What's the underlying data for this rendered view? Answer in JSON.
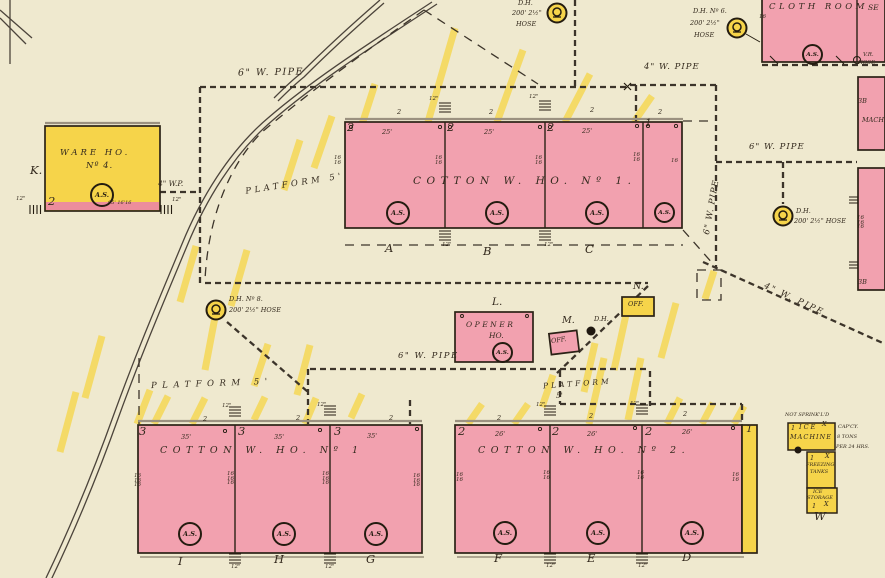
{
  "colors": {
    "background": "#efe9cf",
    "brick_pink": "#f2a1af",
    "brick_shade": "#ec8d9c",
    "frame_yellow": "#f6d44a",
    "stripe_yellow": "#f4d85e",
    "ink": "#33291d",
    "line": "#4c443b"
  },
  "tokens": {
    "as": "A.S.",
    "fire12": "12\"",
    "w16": "16",
    "w16x2": "16 16",
    "w16x3": "16 16 16",
    "story1": "1",
    "story2": "2",
    "story3": "3",
    "d25": "25'",
    "d26": "26'",
    "d35": "35'",
    "x_mark": "X"
  },
  "pipes": {
    "wp6": "6\" W. PIPE",
    "wp4": "4\" W. PIPE",
    "wp4_short": "4\" W.P."
  },
  "platforms": {
    "upper": "PLATFORM 5'",
    "lower_left": "PLATFORM 5'",
    "mid_right_1": "PLATFORM",
    "mid_right_2": "5'"
  },
  "hydrants": {
    "top_center": {
      "name": "D.H.",
      "hose_1": "200' 2½\"",
      "hose_2": "HOSE"
    },
    "no6": {
      "name": "D.H. Nº 6.",
      "hose_1": "200' 2½\"",
      "hose_2": "HOSE"
    },
    "no8": {
      "name": "D.H. Nº 8.",
      "hose": "200' 2½\" HOSE"
    },
    "right": {
      "name": "D.H.",
      "hose": "200' 2½\" HOSE"
    },
    "small": {
      "name": "D.H."
    }
  },
  "buildings": {
    "ware_ho": {
      "letter": "K.",
      "name_1": "WARE HO.",
      "name_2": "Nº 4.",
      "stories": "2",
      "dim": "95' 16'16"
    },
    "cotton_top": {
      "name": "COTTON W. HO. Nº 1.",
      "sections": {
        "a": "A",
        "b": "B",
        "c": "C"
      }
    },
    "cotton_bottom_left": {
      "name": "COTTON W. HO. Nº 1",
      "sections": {
        "i": "I",
        "h": "H",
        "g": "G"
      }
    },
    "cotton_bottom_right": {
      "name": "COTTON W. HO. Nº 2.",
      "sections": {
        "f": "F",
        "e": "E",
        "d": "D"
      }
    },
    "cloth_room": {
      "name": "CLOTH ROOM",
      "edge": "SE"
    },
    "opener": {
      "letter": "L.",
      "name_1": "OPENER",
      "name_2": "HO."
    },
    "office_m": {
      "letter": "M.",
      "name": "OFF."
    },
    "office_n": {
      "letter": "N.",
      "name": "OFF."
    },
    "ice_plant": {
      "note": "NOT SPRINK'L'D",
      "machine_1": "ICE",
      "machine_2": "MACHINE",
      "tanks_1": "FREEZING",
      "tanks_2": "TANKS",
      "storage_1": "ICE",
      "storage_2": "STORAGE",
      "letter": "W",
      "cap_1": "CAP'CY.",
      "cap_2": "8 TONS",
      "cap_3": "PER 24 HRS."
    },
    "right_edge": {
      "b3_top": "3B",
      "mach": "MACH",
      "b3_bottom": "3B",
      "vr_1": "V.R.",
      "vr_2": "HOSE"
    }
  }
}
